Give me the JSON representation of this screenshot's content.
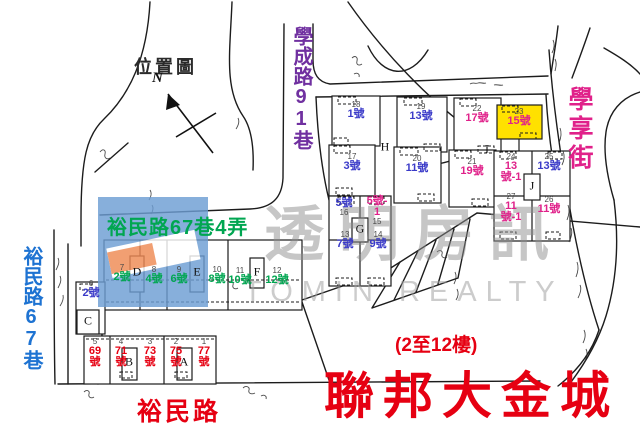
{
  "palette": {
    "blue": "#3a3ac8",
    "magenta": "#e0218a",
    "green": "#00a651",
    "red": "#e60012",
    "purple": "#7030a0",
    "streetBlue": "#1e73d2",
    "yellow": "#ffe100",
    "logoBlue": "#6d9ed4",
    "ink": "#1c1c1c"
  },
  "map": {
    "title": "位置圖",
    "compass_label": "N",
    "streets": {
      "xuecheng": "學成路91巷",
      "xuexiang": "學享街",
      "yumin_lane4": "裕民路67巷4弄",
      "yumin_lane67": "裕民路67巷",
      "yumin_road": "裕民路"
    },
    "blocks": {
      "a": "A",
      "b": "B",
      "c": "C",
      "d": "D",
      "e": "E",
      "f": "F",
      "g": "G",
      "h": "H",
      "i": "I",
      "j": "J"
    },
    "plots": [
      {
        "lot": "18",
        "unit": "1號",
        "color": "blue"
      },
      {
        "lot": "19",
        "unit": "13號",
        "color": "blue"
      },
      {
        "lot": "22",
        "unit": "17號",
        "color": "magenta"
      },
      {
        "lot": "23",
        "unit": "15號",
        "color": "magenta",
        "highlight": "yellow"
      },
      {
        "lot": "17",
        "unit": "3號",
        "color": "blue"
      },
      {
        "lot": "20",
        "unit": "11號",
        "color": "blue"
      },
      {
        "lot": "21",
        "unit": "19號",
        "color": "magenta"
      },
      {
        "lot": "24",
        "unit": "13號-1",
        "color": "magenta"
      },
      {
        "lot": "25",
        "unit": "13號",
        "color": "blue"
      },
      {
        "lot": "27",
        "unit": "11號-1",
        "color": "magenta"
      },
      {
        "lot": "26",
        "unit": "11號",
        "color": "magenta"
      },
      {
        "lot": "16",
        "unit": "5號",
        "color": "blue"
      },
      {
        "lot": "15",
        "unit": "5號-1",
        "color": "magenta"
      },
      {
        "lot": "13",
        "unit": "7號",
        "color": "blue"
      },
      {
        "lot": "14",
        "unit": "9號",
        "color": "blue"
      },
      {
        "lot": "6",
        "unit": "2號",
        "color": "blue"
      },
      {
        "lot": "7",
        "unit": "2號",
        "color": "green"
      },
      {
        "lot": "8",
        "unit": "4號",
        "color": "green"
      },
      {
        "lot": "9",
        "unit": "6號",
        "color": "green"
      },
      {
        "lot": "10",
        "unit": "8號",
        "color": "green"
      },
      {
        "lot": "11",
        "unit": "10號",
        "color": "green"
      },
      {
        "lot": "12",
        "unit": "12號",
        "color": "green"
      },
      {
        "lot": "5",
        "unit": "69號",
        "color": "red"
      },
      {
        "lot": "4",
        "unit": "71號",
        "color": "red"
      },
      {
        "lot": "3",
        "unit": "73號",
        "color": "red"
      },
      {
        "lot": "2",
        "unit": "75號",
        "color": "red"
      },
      {
        "lot": "1",
        "unit": "77號",
        "color": "red"
      }
    ],
    "project": {
      "floors_note": "(2至12樓)",
      "name": "聯邦大金城"
    },
    "watermark": {
      "cn": "透明房訊",
      "en": "TOMIN REALTY"
    }
  }
}
